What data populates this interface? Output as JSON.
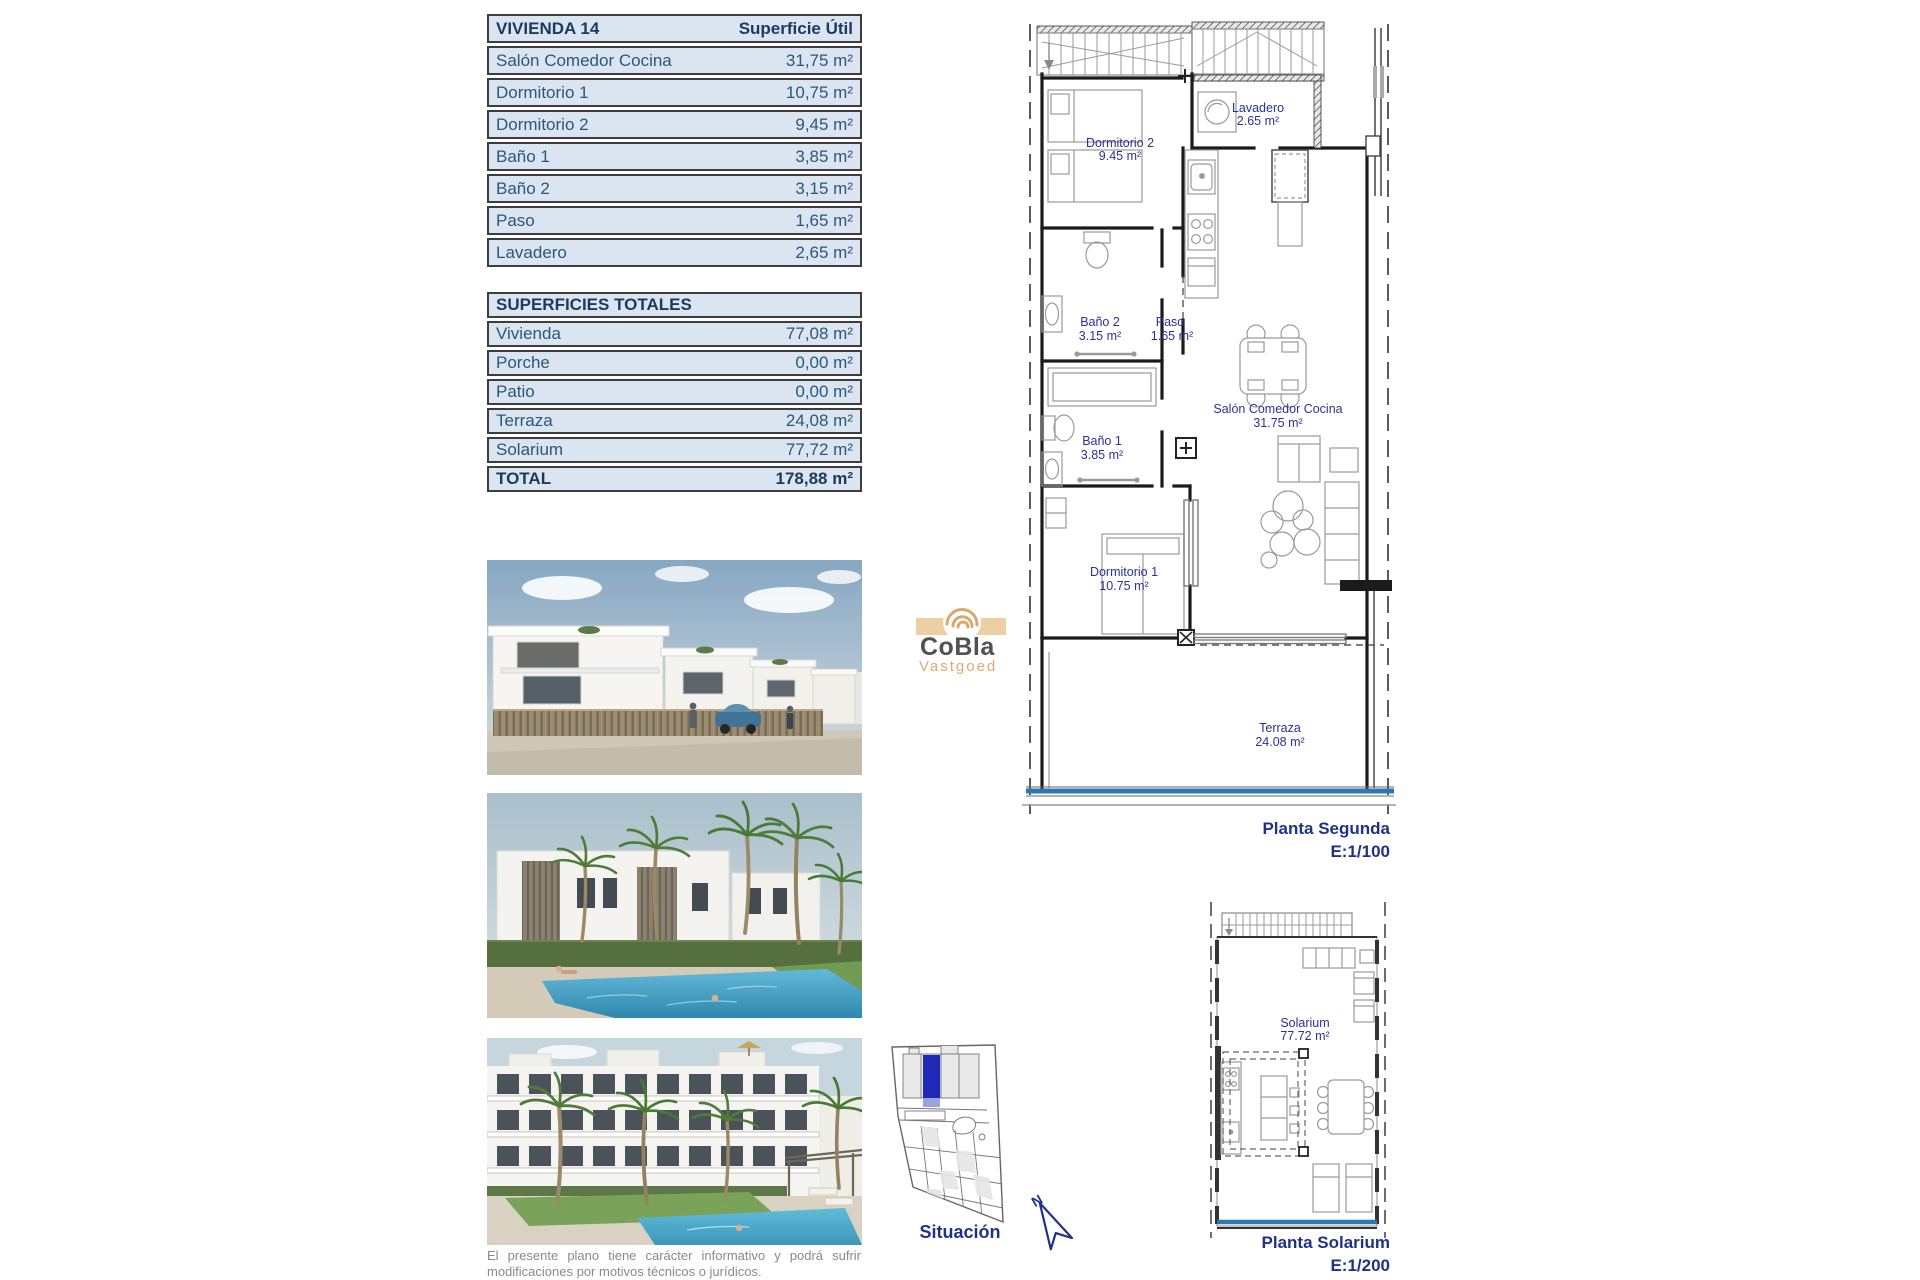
{
  "tables": {
    "vivienda": {
      "title": "VIVIENDA 14",
      "header_right": "Superficie Útil",
      "rows": [
        {
          "name": "Salón Comedor Cocina",
          "value": "31,75 m²"
        },
        {
          "name": "Dormitorio 1",
          "value": "10,75 m²"
        },
        {
          "name": "Dormitorio 2",
          "value": "9,45 m²"
        },
        {
          "name": "Baño 1",
          "value": "3,85 m²"
        },
        {
          "name": "Baño 2",
          "value": "3,15 m²"
        },
        {
          "name": "Paso",
          "value": "1,65 m²"
        },
        {
          "name": "Lavadero",
          "value": "2,65 m²"
        }
      ]
    },
    "totales": {
      "title": "SUPERFICIES TOTALES",
      "rows": [
        {
          "name": "Vivienda",
          "value": "77,08 m²"
        },
        {
          "name": "Porche",
          "value": "0,00 m²"
        },
        {
          "name": "Patio",
          "value": "0,00 m²"
        },
        {
          "name": "Terraza",
          "value": "24,08 m²"
        },
        {
          "name": "Solarium",
          "value": "77,72 m²"
        }
      ],
      "total": {
        "name": "TOTAL",
        "value": "178,88 m²"
      }
    }
  },
  "plans": {
    "segunda": {
      "caption": "Planta Segunda",
      "scale": "E:1/100",
      "rooms": {
        "dormitorio2": {
          "name": "Dormitorio 2",
          "area": "9.45 m²"
        },
        "lavadero": {
          "name": "Lavadero",
          "area": "2.65 m²"
        },
        "bano2": {
          "name": "Baño 2",
          "area": "3.15 m²"
        },
        "paso": {
          "name": "Paso",
          "area": "1.65 m²"
        },
        "bano1": {
          "name": "Baño 1",
          "area": "3.85 m²"
        },
        "salon": {
          "name": "Salón Comedor Cocina",
          "area": "31.75 m²"
        },
        "dormitorio1": {
          "name": "Dormitorio 1",
          "area": "10.75 m²"
        },
        "terraza": {
          "name": "Terraza",
          "area": "24.08 m²"
        }
      }
    },
    "solarium": {
      "caption": "Planta Solarium",
      "scale": "E:1/200",
      "room": {
        "name": "Solarium",
        "area": "77.72 m²"
      }
    },
    "situacion": {
      "caption": "Situación",
      "north": "N"
    }
  },
  "logo": {
    "name": "CoBla",
    "sub": "Vastgoed"
  },
  "disclaimer": "El presente plano tiene carácter informativo y podrá sufrir modificaciones por motivos técnicos o jurídicos.",
  "colors": {
    "table_bg": "#dbe5f1",
    "table_text": "#2c5777",
    "table_header_text": "#1c3a5e",
    "plan_label": "#2d3193",
    "caption_navy": "#1f3288",
    "balustrade_blue": "#2e78ad",
    "situacion_highlight": "#2028b8",
    "logo_gray": "#515151",
    "logo_tan": "#dcab72"
  }
}
